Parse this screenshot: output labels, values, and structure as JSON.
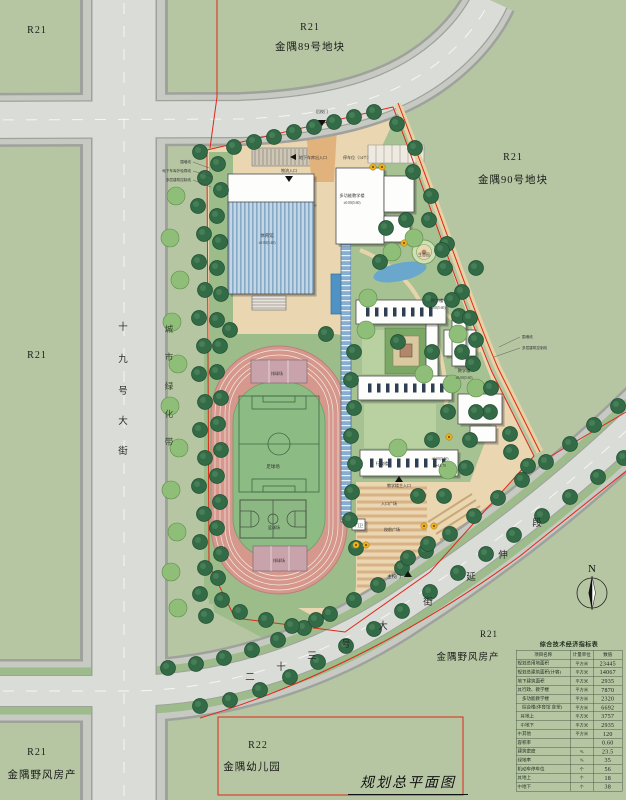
{
  "title": "规划总平面图",
  "plots": {
    "tl": {
      "code": "R21",
      "name": ""
    },
    "p89": {
      "code": "R21",
      "name": "金隅89号地块"
    },
    "p90": {
      "code": "R21",
      "name": "金隅90号地块"
    },
    "ml": {
      "code": "R21",
      "name": ""
    },
    "bl": {
      "code": "R21",
      "name": "金隅野风房产"
    },
    "br": {
      "code": "R21",
      "name": "金隅野风房产"
    },
    "kg": {
      "code": "R22",
      "name": "金隅幼儿园"
    }
  },
  "streets": {
    "west": "十九号大街",
    "greenbelt": "城市绿化带",
    "south": "二十三号大街延伸段"
  },
  "north_label": "N",
  "site_labels": {
    "gate_back": "后校门",
    "garage_entry": "地下车库出入口",
    "parking": "停车位（14个）",
    "logistics": "物流入口",
    "gym": "体育馆",
    "gym_elev": "±0.00(5.40)",
    "multi": "多功能教学楼",
    "multi_elev": "±0.00(5.60)",
    "teach1": "教学楼",
    "teach1_elev": "±0.00(5.60)",
    "teach2": "教学楼",
    "teach2_elev": "±0.00(5.60)",
    "admin": "行政楼",
    "admin_elev": "±0.00(5.50)",
    "admin_h": "h=14.70",
    "main_entry": "教学楼主入口",
    "entry_plaza": "入口广场",
    "front_plaza": "校前广场",
    "guard": "门卫",
    "gate_main": "主校门",
    "volleyball_n": "排球场",
    "soccer": "足球场",
    "basketball": "篮球场",
    "volleyball_s": "排球场",
    "wall_l": "围墙线",
    "garage_line": "地下车库外轮廓线",
    "control_line": "多层建筑控制线",
    "wall_r": "围墙线",
    "ctrl_r": "多层建筑控制线",
    "eco": "生态园"
  },
  "table": {
    "title": "综合技术经济指标表",
    "headers": [
      "项目名称",
      "计量单位",
      "数值"
    ],
    "rows": [
      {
        "g": "",
        "g2": "",
        "name": "规划总用地面积",
        "unit": "平方米",
        "value": "23445"
      },
      {
        "g": "",
        "g2": "",
        "name": "规划总建筑面积(计容)",
        "unit": "平方米",
        "value": "14067"
      },
      {
        "g": "",
        "g2": "",
        "name": "地下建筑面积",
        "unit": "平方米",
        "value": "2935"
      },
      {
        "g": "其",
        "g2": "",
        "name": "行政、教学楼",
        "unit": "平方米",
        "value": "7870"
      },
      {
        "g": "",
        "g2": "",
        "name": "多功能教学楼",
        "unit": "平方米",
        "value": "2320"
      },
      {
        "g": "",
        "g2": "",
        "name": "综合楼(体育馆 食堂)",
        "unit": "平方米",
        "value": "6692"
      },
      {
        "g": "",
        "g2": "其",
        "name": "地上",
        "unit": "平方米",
        "value": "3757"
      },
      {
        "g": "",
        "g2": "中",
        "name": "地下",
        "unit": "平方米",
        "value": "2935"
      },
      {
        "g": "中",
        "g2": "",
        "name": "其他",
        "unit": "平方米",
        "value": "120"
      },
      {
        "g": "",
        "g2": "",
        "name": "容积率",
        "unit": "",
        "value": "0.60"
      },
      {
        "g": "",
        "g2": "",
        "name": "建筑密度",
        "unit": "%",
        "value": "23.5"
      },
      {
        "g": "",
        "g2": "",
        "name": "绿地率",
        "unit": "%",
        "value": "35"
      },
      {
        "g": "",
        "g2": "",
        "name": "机动车停车位",
        "unit": "个",
        "value": "56"
      },
      {
        "g": "其",
        "g2": "",
        "name": "地上",
        "unit": "个",
        "value": "18"
      },
      {
        "g": "中",
        "g2": "",
        "name": "地下",
        "unit": "个",
        "value": "38"
      }
    ]
  }
}
